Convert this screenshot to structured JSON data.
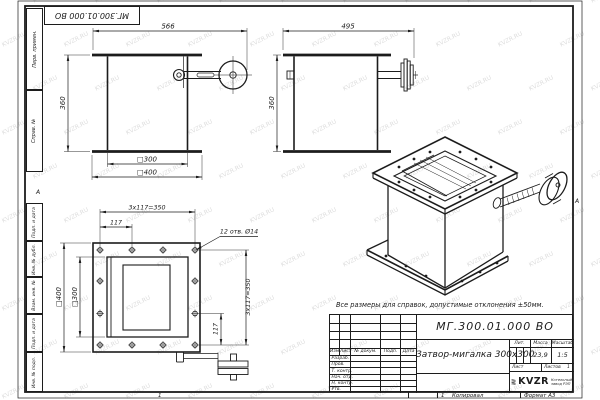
{
  "watermark": {
    "text": "KVZR.RU"
  },
  "margins": {
    "top_designation": "МГ.300.01.000 ВО",
    "left_top": [
      "Перв. примен.",
      "Справ. №"
    ],
    "left_bottom": [
      "Подп. и дата",
      "Инв. № дубл.",
      "Взам. инв. №",
      "Подп. и дата",
      "Инв. № подл."
    ],
    "zone_left": "А",
    "zone_right": "А",
    "bottom_zone_1": "1",
    "bottom_zone_2": "1",
    "copied": "Копировал",
    "format": "Формат А3"
  },
  "note": "Все размеры для справок, допустимые отклонения ±50мм.",
  "dims": {
    "front": {
      "total_width": "566",
      "height": "360",
      "inner": "□300",
      "outer": "□400"
    },
    "side": {
      "total_width": "495",
      "height": "360"
    },
    "plan": {
      "row_pitch": "3x117=350",
      "pitch_first": "117",
      "holes": "12 отв. Ø14",
      "outer": "□400",
      "inner": "□300",
      "col_pitch": "3x117=350",
      "pitch_last": "117"
    }
  },
  "title_block": {
    "designation": "МГ.300.01.000 ВО",
    "name": "Затвор-мигалка 300х300",
    "columns": {
      "izm": "Изм.",
      "list": "Лист",
      "doc": "№ докум.",
      "podp": "Подп.",
      "data": "Дата"
    },
    "roles": [
      "Разраб.",
      "Пров.",
      "Т. контр.",
      "Нач. отд.",
      "Н. контр.",
      "Утв."
    ],
    "lit_label": "Лит.",
    "mass_label": "Масса",
    "scale_label": "Масштаб",
    "mass_value": "23,9",
    "scale_value": "1:5",
    "sheet_label": "Лист",
    "sheets_label": "Листов",
    "sheets_value": "1",
    "logo_text": "KVZR",
    "company_line1": "Котельный",
    "company_line2": "завод РЭП"
  }
}
